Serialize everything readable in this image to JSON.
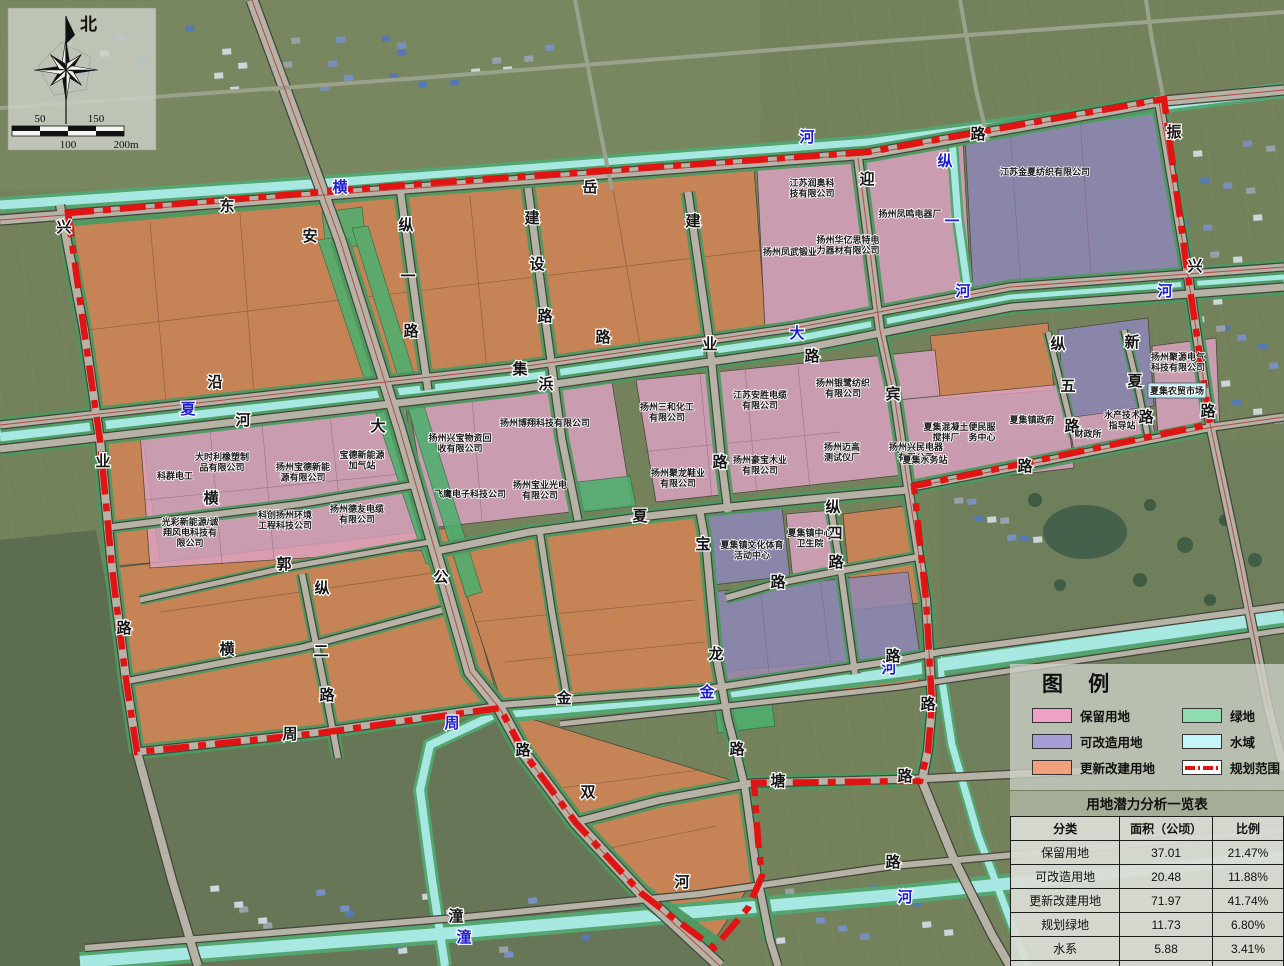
{
  "map": {
    "compass": {
      "north_label": "北"
    },
    "scale_bar": {
      "t50": "50",
      "t100": "100",
      "t150": "150",
      "t200": "200m"
    },
    "labels": [
      {
        "t": "横",
        "x": 340,
        "y": 192,
        "c": "w"
      },
      {
        "t": "河",
        "x": 807,
        "y": 142,
        "c": "w"
      },
      {
        "t": "夏",
        "x": 188,
        "y": 414,
        "c": "w"
      },
      {
        "t": "大",
        "x": 797,
        "y": 338,
        "c": "w"
      },
      {
        "t": "河",
        "x": 963,
        "y": 296,
        "c": "w"
      },
      {
        "t": "河",
        "x": 1165,
        "y": 296,
        "c": "w"
      },
      {
        "t": "纵",
        "x": 945,
        "y": 166,
        "c": "w"
      },
      {
        "t": "一",
        "x": 952,
        "y": 226,
        "c": "w"
      },
      {
        "t": "周",
        "x": 452,
        "y": 728,
        "c": "w"
      },
      {
        "t": "金",
        "x": 707,
        "y": 697,
        "c": "w"
      },
      {
        "t": "河",
        "x": 889,
        "y": 673,
        "c": "w"
      },
      {
        "t": "潼",
        "x": 464,
        "y": 942,
        "c": "w"
      },
      {
        "t": "河",
        "x": 905,
        "y": 902,
        "c": "w"
      },
      {
        "t": "兴",
        "x": 64,
        "y": 232,
        "c": "r"
      },
      {
        "t": "业",
        "x": 103,
        "y": 466,
        "c": "r"
      },
      {
        "t": "路",
        "x": 124,
        "y": 633,
        "c": "r"
      },
      {
        "t": "东",
        "x": 227,
        "y": 211,
        "c": "r"
      },
      {
        "t": "安",
        "x": 310,
        "y": 241,
        "c": "r"
      },
      {
        "t": "公",
        "x": 441,
        "y": 582,
        "c": "r"
      },
      {
        "t": "路",
        "x": 523,
        "y": 755,
        "c": "r"
      },
      {
        "t": "沿",
        "x": 215,
        "y": 387,
        "c": "r"
      },
      {
        "t": "河",
        "x": 243,
        "y": 425,
        "c": "r"
      },
      {
        "t": "集",
        "x": 520,
        "y": 374,
        "c": "r"
      },
      {
        "t": "浜",
        "x": 546,
        "y": 389,
        "c": "r"
      },
      {
        "t": "横",
        "x": 211,
        "y": 503,
        "c": "r"
      },
      {
        "t": "郭",
        "x": 284,
        "y": 569,
        "c": "r"
      },
      {
        "t": "横",
        "x": 227,
        "y": 654,
        "c": "r"
      },
      {
        "t": "纵",
        "x": 322,
        "y": 593,
        "c": "r"
      },
      {
        "t": "二",
        "x": 321,
        "y": 656,
        "c": "r"
      },
      {
        "t": "路",
        "x": 327,
        "y": 700,
        "c": "r"
      },
      {
        "t": "大",
        "x": 378,
        "y": 431,
        "c": "r"
      },
      {
        "t": "纵",
        "x": 406,
        "y": 230,
        "c": "r"
      },
      {
        "t": "一",
        "x": 408,
        "y": 281,
        "c": "r"
      },
      {
        "t": "路",
        "x": 411,
        "y": 336,
        "c": "r"
      },
      {
        "t": "岳",
        "x": 590,
        "y": 192,
        "c": "r"
      },
      {
        "t": "建",
        "x": 532,
        "y": 223,
        "c": "r"
      },
      {
        "t": "设",
        "x": 537,
        "y": 269,
        "c": "r"
      },
      {
        "t": "路",
        "x": 545,
        "y": 321,
        "c": "r"
      },
      {
        "t": "路",
        "x": 603,
        "y": 342,
        "c": "r"
      },
      {
        "t": "建",
        "x": 693,
        "y": 226,
        "c": "r"
      },
      {
        "t": "业",
        "x": 710,
        "y": 349,
        "c": "r"
      },
      {
        "t": "路",
        "x": 720,
        "y": 467,
        "c": "r"
      },
      {
        "t": "迎",
        "x": 867,
        "y": 184,
        "c": "r"
      },
      {
        "t": "宾",
        "x": 893,
        "y": 399,
        "c": "r"
      },
      {
        "t": "路",
        "x": 812,
        "y": 361,
        "c": "r"
      },
      {
        "t": "路",
        "x": 978,
        "y": 139,
        "c": "r"
      },
      {
        "t": "振",
        "x": 1174,
        "y": 137,
        "c": "r"
      },
      {
        "t": "兴",
        "x": 1195,
        "y": 271,
        "c": "r"
      },
      {
        "t": "路",
        "x": 1208,
        "y": 416,
        "c": "r"
      },
      {
        "t": "纵",
        "x": 1058,
        "y": 349,
        "c": "r"
      },
      {
        "t": "五",
        "x": 1068,
        "y": 391,
        "c": "r"
      },
      {
        "t": "路",
        "x": 1072,
        "y": 431,
        "c": "r"
      },
      {
        "t": "新",
        "x": 1132,
        "y": 347,
        "c": "r"
      },
      {
        "t": "夏",
        "x": 1135,
        "y": 386,
        "c": "r"
      },
      {
        "t": "路",
        "x": 1146,
        "y": 422,
        "c": "r"
      },
      {
        "t": "路",
        "x": 1025,
        "y": 471,
        "c": "r"
      },
      {
        "t": "夏",
        "x": 640,
        "y": 521,
        "c": "r"
      },
      {
        "t": "路",
        "x": 778,
        "y": 587,
        "c": "r"
      },
      {
        "t": "宝",
        "x": 703,
        "y": 549,
        "c": "r"
      },
      {
        "t": "龙",
        "x": 716,
        "y": 659,
        "c": "r"
      },
      {
        "t": "路",
        "x": 737,
        "y": 754,
        "c": "r"
      },
      {
        "t": "纵",
        "x": 833,
        "y": 512,
        "c": "r"
      },
      {
        "t": "四",
        "x": 835,
        "y": 538,
        "c": "r"
      },
      {
        "t": "路",
        "x": 836,
        "y": 567,
        "c": "r"
      },
      {
        "t": "金",
        "x": 564,
        "y": 703,
        "c": "r"
      },
      {
        "t": "塘",
        "x": 778,
        "y": 786,
        "c": "r"
      },
      {
        "t": "路",
        "x": 905,
        "y": 781,
        "c": "r"
      },
      {
        "t": "双",
        "x": 588,
        "y": 797,
        "c": "r"
      },
      {
        "t": "周",
        "x": 290,
        "y": 739,
        "c": "r"
      },
      {
        "t": "路",
        "x": 893,
        "y": 661,
        "c": "r"
      },
      {
        "t": "路",
        "x": 928,
        "y": 709,
        "c": "r"
      },
      {
        "t": "路",
        "x": 893,
        "y": 867,
        "c": "r"
      },
      {
        "t": "潼",
        "x": 456,
        "y": 921,
        "c": "r"
      },
      {
        "t": "河",
        "x": 682,
        "y": 887,
        "c": "r"
      },
      {
        "t": "江苏润奥科\n技有限公司",
        "x": 812,
        "y": 186,
        "c": "n"
      },
      {
        "t": "扬州凤武锻业",
        "x": 790,
        "y": 255,
        "c": "n"
      },
      {
        "t": "扬州华亿思特电\n力器材有限公司",
        "x": 848,
        "y": 243,
        "c": "n"
      },
      {
        "t": "扬州凤鸣电器厂",
        "x": 910,
        "y": 217,
        "c": "n"
      },
      {
        "t": "江苏金夏纺织有限公司",
        "x": 1045,
        "y": 175,
        "c": "n"
      },
      {
        "t": "扬州银鹭纺织\n有限公司",
        "x": 843,
        "y": 386,
        "c": "n"
      },
      {
        "t": "扬州三和化工\n有限公司",
        "x": 667,
        "y": 410,
        "c": "n"
      },
      {
        "t": "江苏安胜电缆\n有限公司",
        "x": 760,
        "y": 398,
        "c": "n"
      },
      {
        "t": "扬州豪宝木业\n有限公司",
        "x": 760,
        "y": 463,
        "c": "n"
      },
      {
        "t": "扬州迈高\n测试仪厂",
        "x": 842,
        "y": 450,
        "c": "n"
      },
      {
        "t": "扬州兴民电器\n有限公司",
        "x": 916,
        "y": 450,
        "c": "n"
      },
      {
        "t": "扬州聚龙鞋业\n有限公司",
        "x": 678,
        "y": 476,
        "c": "n"
      },
      {
        "t": "扬州兴宝物资回\n收有限公司",
        "x": 460,
        "y": 441,
        "c": "n"
      },
      {
        "t": "扬州博翔科技有限公司",
        "x": 545,
        "y": 426,
        "c": "n"
      },
      {
        "t": "宝德新能源\n加气站",
        "x": 362,
        "y": 458,
        "c": "n"
      },
      {
        "t": "飞鹰电子科技公司",
        "x": 470,
        "y": 497,
        "c": "n"
      },
      {
        "t": "扬州宝业光电\n有限公司",
        "x": 540,
        "y": 488,
        "c": "n"
      },
      {
        "t": "扬州德友电缆\n有限公司",
        "x": 357,
        "y": 512,
        "c": "n"
      },
      {
        "t": "科群电工",
        "x": 175,
        "y": 479,
        "c": "n"
      },
      {
        "t": "大时利橡塑制\n品有限公司",
        "x": 222,
        "y": 460,
        "c": "n"
      },
      {
        "t": "扬州宝德新能\n源有限公司",
        "x": 303,
        "y": 470,
        "c": "n"
      },
      {
        "t": "光彩新能源/诚\n翔风电科技有\n限公司",
        "x": 190,
        "y": 525,
        "c": "n"
      },
      {
        "t": "科创扬州环境\n工程科技公司",
        "x": 285,
        "y": 518,
        "c": "n"
      },
      {
        "t": "夏集混凝土\n搅拌厂",
        "x": 946,
        "y": 430,
        "c": "n"
      },
      {
        "t": "便民服\n务中心",
        "x": 982,
        "y": 430,
        "c": "n"
      },
      {
        "t": "夏集镇政府",
        "x": 1032,
        "y": 423,
        "c": "n"
      },
      {
        "t": "夏集水务站",
        "x": 925,
        "y": 463,
        "c": "n"
      },
      {
        "t": "财政所",
        "x": 1088,
        "y": 437,
        "c": "n"
      },
      {
        "t": "水产技术\n指导站",
        "x": 1122,
        "y": 418,
        "c": "n"
      },
      {
        "t": "扬州聚源电气\n科技有限公司",
        "x": 1178,
        "y": 360,
        "c": "n"
      },
      {
        "t": "夏集农贸市场",
        "x": 1177,
        "y": 394,
        "c": "n"
      },
      {
        "t": "夏集镇文化体育\n活动中心",
        "x": 752,
        "y": 548,
        "c": "n"
      },
      {
        "t": "夏集镇中心\n卫生院",
        "x": 810,
        "y": 536,
        "c": "n"
      }
    ]
  },
  "legend": {
    "title": "图 例",
    "items": [
      {
        "label": "保留用地",
        "color": "#f0a2c6",
        "type": "fill"
      },
      {
        "label": "可改造用地",
        "color": "#a79ed6",
        "type": "fill"
      },
      {
        "label": "更新改建用地",
        "color": "#f2a07c",
        "type": "fill"
      },
      {
        "label": "绿地",
        "color": "#8fdcae",
        "type": "fill"
      },
      {
        "label": "水域",
        "color": "#c4f6f8",
        "type": "fill"
      },
      {
        "label": "规划范围",
        "color": "#e11414",
        "type": "dash"
      }
    ]
  },
  "table": {
    "title": "用地潜力分析一览表",
    "headers": [
      "分类",
      "面积（公顷）",
      "比例"
    ],
    "rows": [
      [
        "保留用地",
        "37.01",
        "21.47%"
      ],
      [
        "可改造用地",
        "20.48",
        "11.88%"
      ],
      [
        "更新改建用地",
        "71.97",
        "41.74%"
      ],
      [
        "规划绿地",
        "11.73",
        "6.80%"
      ],
      [
        "水系",
        "5.88",
        "3.41%"
      ],
      [
        "道路",
        "25.34",
        "14.70%"
      ]
    ]
  },
  "colors": {
    "retain_pink": "#dfa3c6",
    "reform_purple": "#8f88bd",
    "renew_orange": "#dd8455",
    "green": "#4fae6e",
    "water": "#a8e8e2",
    "boundary_red": "#e11414"
  }
}
